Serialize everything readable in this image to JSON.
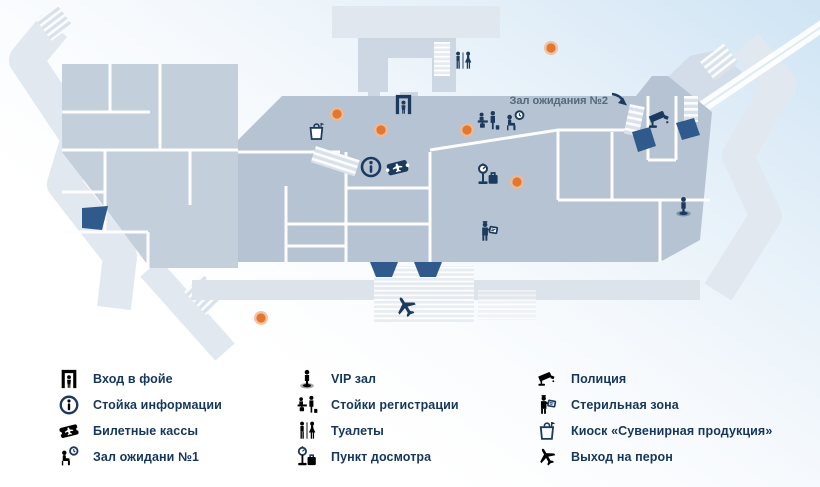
{
  "map": {
    "hall2_label": "Зал ожидания №2",
    "marker_icons": [
      "toilets-icon",
      "entrance-icon",
      "kiosk-icon",
      "info-icon",
      "tickets-icon",
      "checkin-icon",
      "waiting-icon",
      "inspection-icon",
      "sterile-zone-icon",
      "police-camera-icon",
      "vip-icon",
      "plane-icon"
    ],
    "orange_marker_count": 6
  },
  "legend": {
    "items": [
      {
        "icon": "entrance-icon",
        "label": "Вход в фойе"
      },
      {
        "icon": "info-icon",
        "label": "Стойка информации"
      },
      {
        "icon": "tickets-icon",
        "label": "Билетные кассы"
      },
      {
        "icon": "waiting-icon",
        "label": "Зал ожидани №1"
      },
      {
        "icon": "vip-icon",
        "label": "VIP зал"
      },
      {
        "icon": "checkin-icon",
        "label": "Стойки регистрации"
      },
      {
        "icon": "toilets-icon",
        "label": "Туалеты"
      },
      {
        "icon": "inspection-icon",
        "label": "Пункт досмотра"
      },
      {
        "icon": "police-icon",
        "label": "Полиция"
      },
      {
        "icon": "sterile-icon",
        "label": "Стерильная зона"
      },
      {
        "icon": "kiosk-icon",
        "label": "Киоск «Сувенирная продукция»"
      },
      {
        "icon": "plane-icon",
        "label": "Выход на перон"
      }
    ]
  },
  "colors": {
    "icon_navy": "#1c3a5e",
    "hall_fill": "#b5c3d2",
    "left_block_fill": "#c4cfdc",
    "outer_band_fill": "#e1e8f0",
    "platform_fill": "#dce3eb",
    "marker_orange": "#e2772f",
    "marker_halo": "#f3b990",
    "exit_ramp_navy": "#2f5a8b"
  }
}
